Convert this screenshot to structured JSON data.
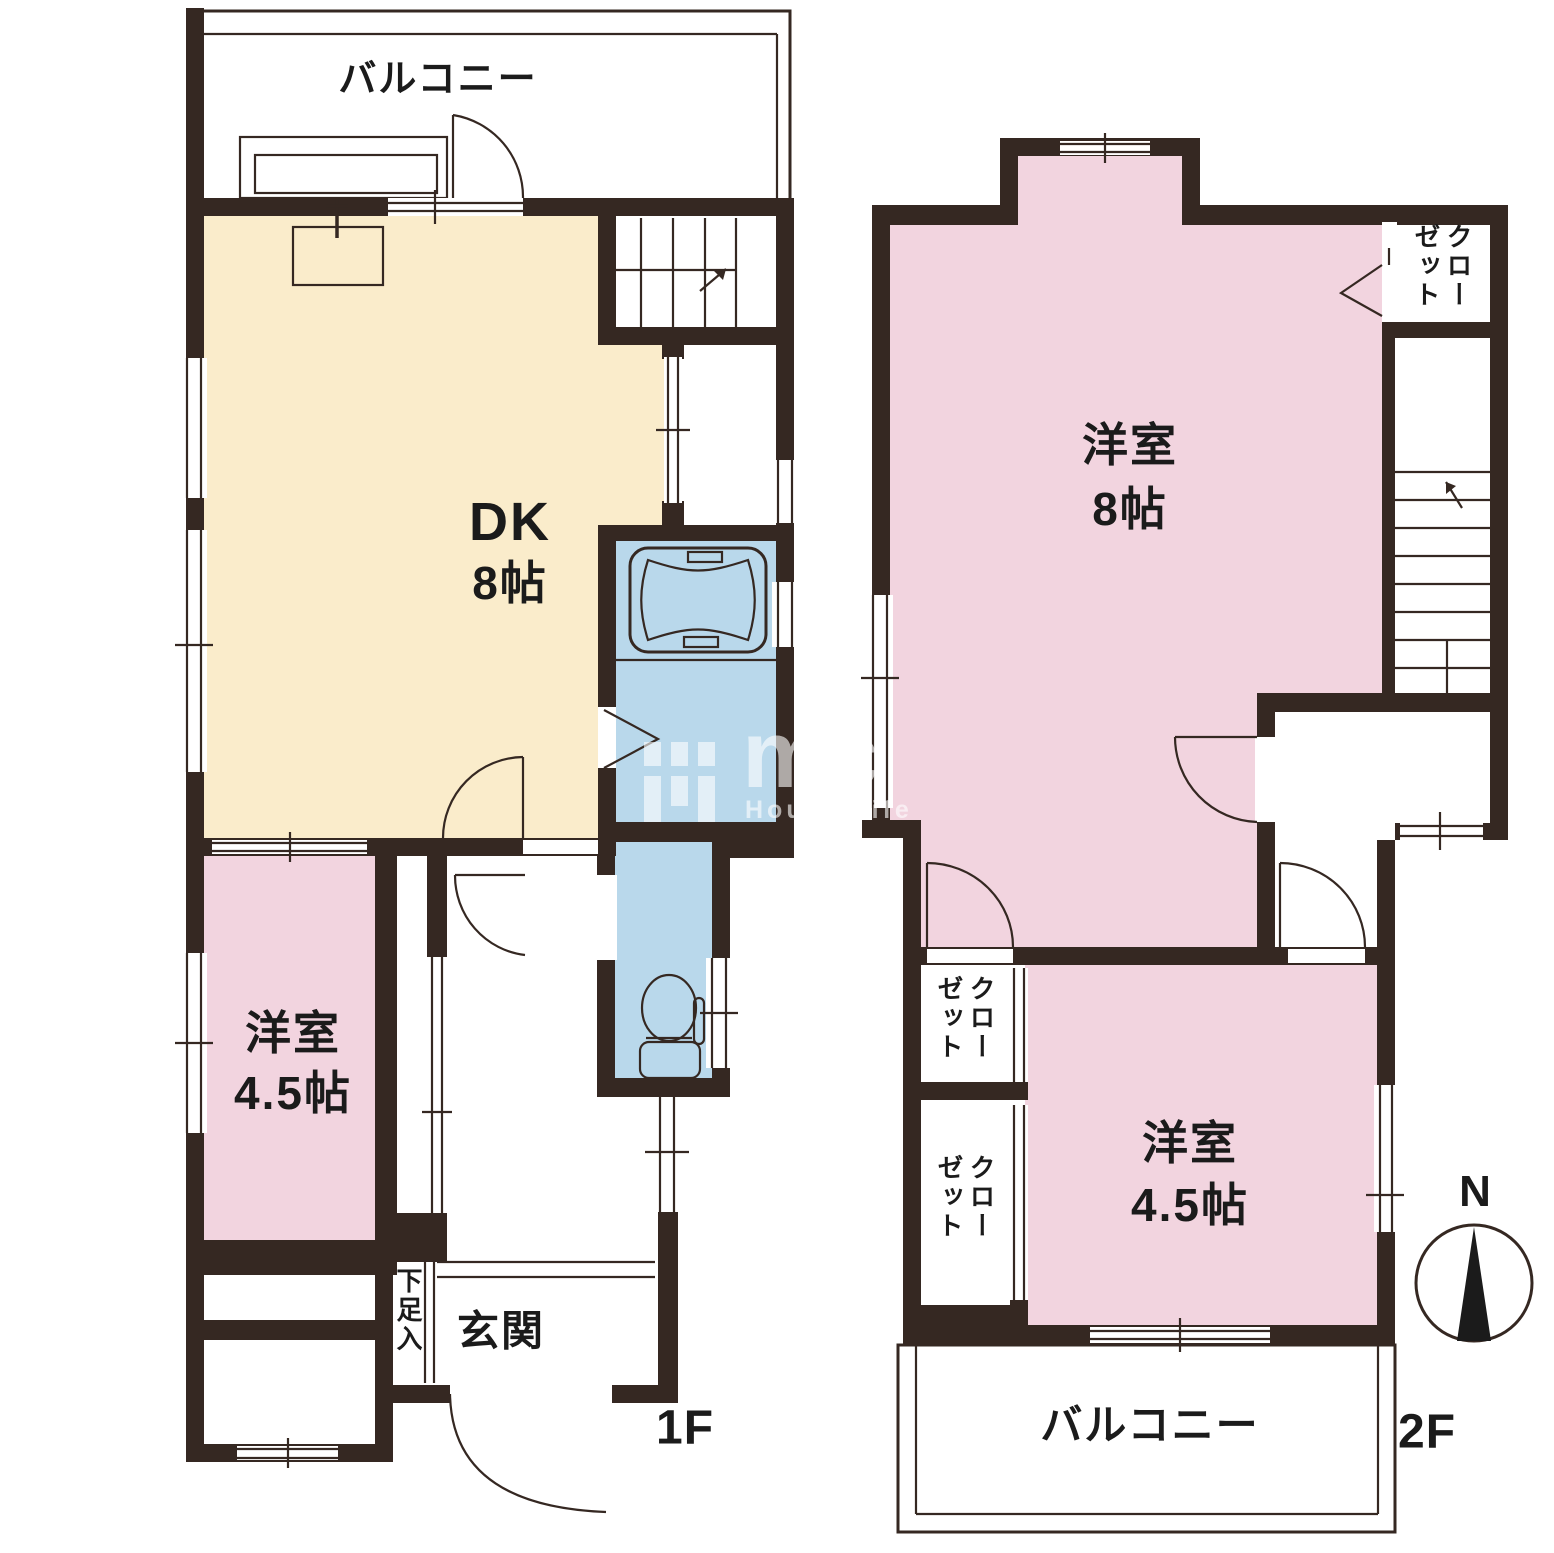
{
  "document_title": "間取り図",
  "colors": {
    "wall": "#352822",
    "room_dk": "#faeccb",
    "room_western": "#f2d4df",
    "room_wet": "#b9d8eb",
    "line": "#1b1b1b",
    "background": "#ffffff"
  },
  "floor1": {
    "floor_label": "1F",
    "balcony_label": "バルコニー",
    "rooms": {
      "dk": {
        "name": "DK",
        "size": "8帖"
      },
      "western_room": {
        "name": "洋室",
        "size": "4.5帖"
      },
      "entrance": {
        "name": "玄関"
      },
      "shoe_storage": {
        "name": "下足入"
      }
    }
  },
  "floor2": {
    "floor_label": "2F",
    "balcony_label": "バルコニー",
    "compass_label": "N",
    "rooms": {
      "western_room_8": {
        "name": "洋室",
        "size": "8帖"
      },
      "western_room_45": {
        "name": "洋室",
        "size": "4.5帖"
      },
      "closet_top": {
        "name": "クローゼット"
      },
      "closet_a": {
        "name": "クローゼット"
      },
      "closet_b": {
        "name": "クローゼット"
      }
    }
  },
  "watermark": {
    "logo_text": "mc",
    "subtitle": "House Life"
  }
}
